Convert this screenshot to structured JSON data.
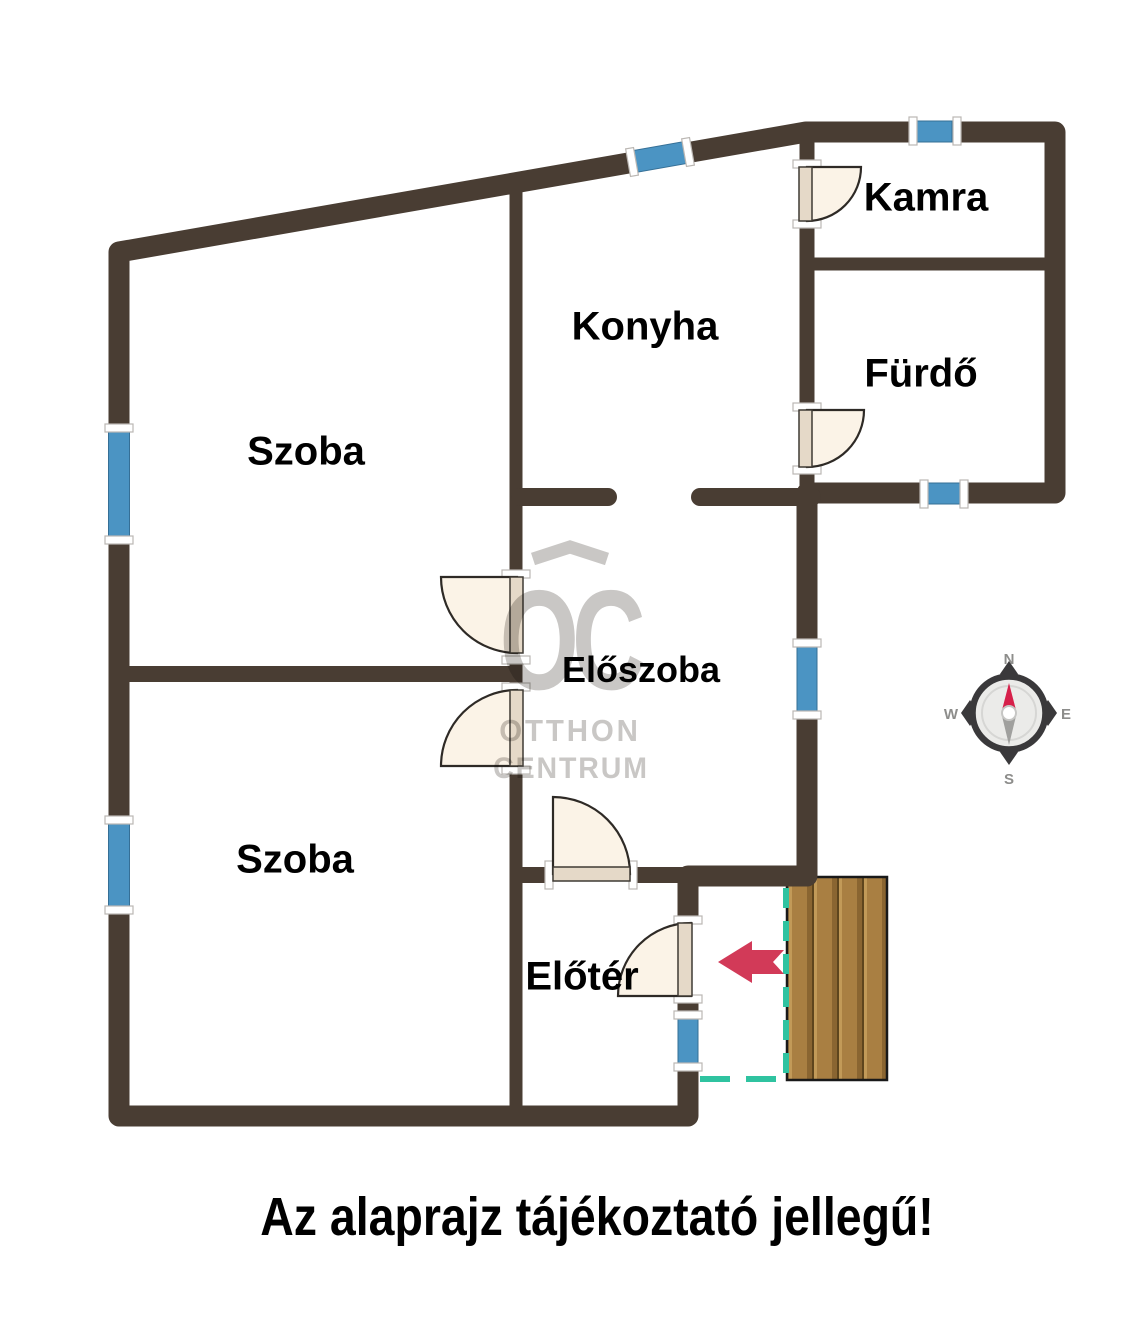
{
  "caption": {
    "text": "Az alaprajz tájékoztató jellegű!",
    "pos": {
      "x": 597,
      "y": 1217,
      "fs": 54,
      "sx": 0.86
    }
  },
  "rooms": [
    {
      "name": "Kamra",
      "pos": {
        "x": 926,
        "y": 198,
        "fs": 40
      }
    },
    {
      "name": "Konyha",
      "pos": {
        "x": 645,
        "y": 327,
        "fs": 40
      }
    },
    {
      "name": "Fürdő",
      "pos": {
        "x": 921,
        "y": 374,
        "fs": 40
      }
    },
    {
      "name": "Szoba",
      "pos": {
        "x": 306,
        "y": 452,
        "fs": 40
      }
    },
    {
      "name": "Előszoba",
      "pos": {
        "x": 641,
        "y": 670,
        "fs": 36
      }
    },
    {
      "name": "Szoba",
      "pos": {
        "x": 295,
        "y": 860,
        "fs": 40
      }
    },
    {
      "name": "Előtér",
      "pos": {
        "x": 582,
        "y": 977,
        "fs": 40
      }
    }
  ],
  "watermark": {
    "oc": "OC",
    "oc_pos": {
      "x": 569,
      "y": 641,
      "fs": 142,
      "sx": 0.72,
      "ls": -10
    },
    "line1": "OTTHON",
    "line1_pos": {
      "x": 570,
      "y": 731,
      "fs": 31,
      "sx": 0.95,
      "ls": 3
    },
    "line2": "CENTRUM",
    "line2_pos": {
      "x": 571,
      "y": 769,
      "fs": 30,
      "sx": 0.95,
      "ls": 2
    },
    "roof_points": "533,559 570,547 607,559"
  },
  "colors": {
    "wall": "#493d33",
    "window": "#4b94c3",
    "window_edge": "#356f96",
    "tick_fill": "#ffffff",
    "tick_edge": "#bbb7b3",
    "door_fill": "#fbf3e7",
    "door_edge": "#2e2a26",
    "leaf_fill": "#e5d9c8",
    "leaf_edge": "#3f3a34",
    "deck_base": "#a97f42",
    "deck_dark": "#8a6531",
    "deck_seam": "#5e451d",
    "deck_light": "#c29a58",
    "deck_border": "#191919",
    "dash": "#2fc3a0",
    "arrow": "#d23a58",
    "watermark": "#c9c7c5",
    "compass_dark": "#3a393b",
    "compass_label": "#8d8d8b",
    "compass_red": "#d6204a",
    "compass_gray": "#a0a09e",
    "compass_disk": "#ebebe9",
    "compass_inner_ring": "#d6d6d4"
  },
  "plan": {
    "exterior": {
      "d": "M688,999 L688,1116 L119,1116 L119,252 L806,132 L1055,132 L1055,493 L807,493 L807,876 L688,876 L688,920",
      "w": 21
    },
    "interior": [
      {
        "d": "M516,182 L516,577",
        "w": 13
      },
      {
        "d": "M516,658 L516,690",
        "w": 13
      },
      {
        "d": "M516,768 L516,1110",
        "w": 13
      },
      {
        "d": "M127,674 L516,674",
        "w": 16
      },
      {
        "d": "M520,497 L608,497",
        "w": 18,
        "cap": "round"
      },
      {
        "d": "M700,497 L812,497",
        "w": 18,
        "cap": "round"
      },
      {
        "d": "M810,264 L1050,264",
        "w": 13
      },
      {
        "d": "M807,138 L807,166",
        "w": 15
      },
      {
        "d": "M807,222 L807,409",
        "w": 15
      },
      {
        "d": "M807,469 L807,500",
        "w": 15
      },
      {
        "d": "M516,875 L551,875",
        "w": 16
      },
      {
        "d": "M631,875 L696,875",
        "w": 16
      }
    ],
    "windows": [
      {
        "x": 108.5,
        "y": 430,
        "w": 21,
        "h": 108
      },
      {
        "x": 108.5,
        "y": 822,
        "w": 21,
        "h": 86
      },
      {
        "x": 635,
        "y": 146,
        "w": 50,
        "h": 22,
        "rot": -10,
        "cx": 660,
        "cy": 157
      },
      {
        "x": 916,
        "y": 121,
        "w": 36,
        "h": 21
      },
      {
        "x": 928,
        "y": 483,
        "w": 32,
        "h": 21
      },
      {
        "x": 797,
        "y": 646,
        "w": 20,
        "h": 66
      },
      {
        "x": 678,
        "y": 1018,
        "w": 20,
        "h": 46
      }
    ],
    "ticks": [
      [
        119,
        428,
        "h"
      ],
      [
        119,
        540,
        "h"
      ],
      [
        119,
        820,
        "h"
      ],
      [
        119,
        910,
        "h"
      ],
      [
        632,
        162,
        "v",
        -10
      ],
      [
        688,
        152,
        "v",
        -10
      ],
      [
        913,
        131,
        "v"
      ],
      [
        957,
        131,
        "v"
      ],
      [
        924,
        494,
        "v"
      ],
      [
        964,
        494,
        "v"
      ],
      [
        807,
        643,
        "h"
      ],
      [
        807,
        715,
        "h"
      ],
      [
        688,
        1015,
        "h"
      ],
      [
        688,
        1067,
        "h"
      ],
      [
        807,
        164,
        "h"
      ],
      [
        807,
        224,
        "h"
      ],
      [
        807,
        407,
        "h"
      ],
      [
        807,
        470,
        "h"
      ],
      [
        516,
        574,
        "h"
      ],
      [
        516,
        660,
        "h"
      ],
      [
        516,
        687,
        "h"
      ],
      [
        516,
        770,
        "h"
      ],
      [
        549,
        875,
        "v"
      ],
      [
        633,
        875,
        "v"
      ],
      [
        688,
        920,
        "h"
      ],
      [
        688,
        999,
        "h"
      ]
    ],
    "doors": [
      {
        "pie": "M807,167 L861,167 A54,54 0 0 1 807,221 Z",
        "leaf": [
          799,
          167,
          13,
          54
        ]
      },
      {
        "pie": "M807,410 L864,410 A57,57 0 0 1 807,467 Z",
        "leaf": [
          799,
          410,
          13,
          57
        ]
      },
      {
        "pie": "M517,577 L441,577 A76,76 0 0 0 517,653 Z",
        "leaf": [
          510,
          577,
          13,
          76
        ]
      },
      {
        "pie": "M517,766 L441,766 A76,76 0 0 1 517,690 Z",
        "leaf": [
          510,
          690,
          13,
          76
        ]
      },
      {
        "pie": "M553,874 L553,797 A77,77 0 0 1 630,874 Z",
        "leaf": [
          553,
          867,
          77,
          14
        ]
      },
      {
        "pie": "M691,996 L691,923 A73,73 0 0 0 618,996 Z",
        "leaf": [
          678,
          923,
          14,
          73
        ]
      }
    ],
    "deck": {
      "x": 787,
      "y": 877,
      "w": 100,
      "h": 203,
      "light": [
        789,
        814,
        839,
        864
      ],
      "dark": [
        807,
        832,
        857,
        882
      ],
      "seams": [
        812,
        837,
        862
      ]
    },
    "dashes": [
      {
        "x1": 786,
        "y1": 888,
        "x2": 786,
        "y2": 1078,
        "da": "20 13"
      },
      {
        "x1": 700,
        "y1": 1079,
        "x2": 788,
        "y2": 1079,
        "da": "30 16"
      }
    ],
    "arrow_points": "718,962 752,941 752,950 784,950 773,962 784,974 752,974 752,983",
    "compass": {
      "cx": 1009,
      "cy": 713,
      "ring_r": 36.5,
      "ring_w": 6.5,
      "disk_r": 33.5,
      "inner_r": 27,
      "diamond_dist": 39,
      "diamond_long": 13,
      "diamond_short": 9,
      "needle_red": "1009,683 1016.5,712 1009,716 1001.5,712",
      "needle_gray": "1009,745 1016.5,714 1009,710 1001.5,714",
      "hub_r": 7,
      "labels": [
        {
          "t": "N",
          "x": 1009,
          "y": 664
        },
        {
          "t": "E",
          "x": 1066,
          "y": 719
        },
        {
          "t": "S",
          "x": 1009,
          "y": 784
        },
        {
          "t": "W",
          "x": 951,
          "y": 719
        }
      ]
    }
  }
}
